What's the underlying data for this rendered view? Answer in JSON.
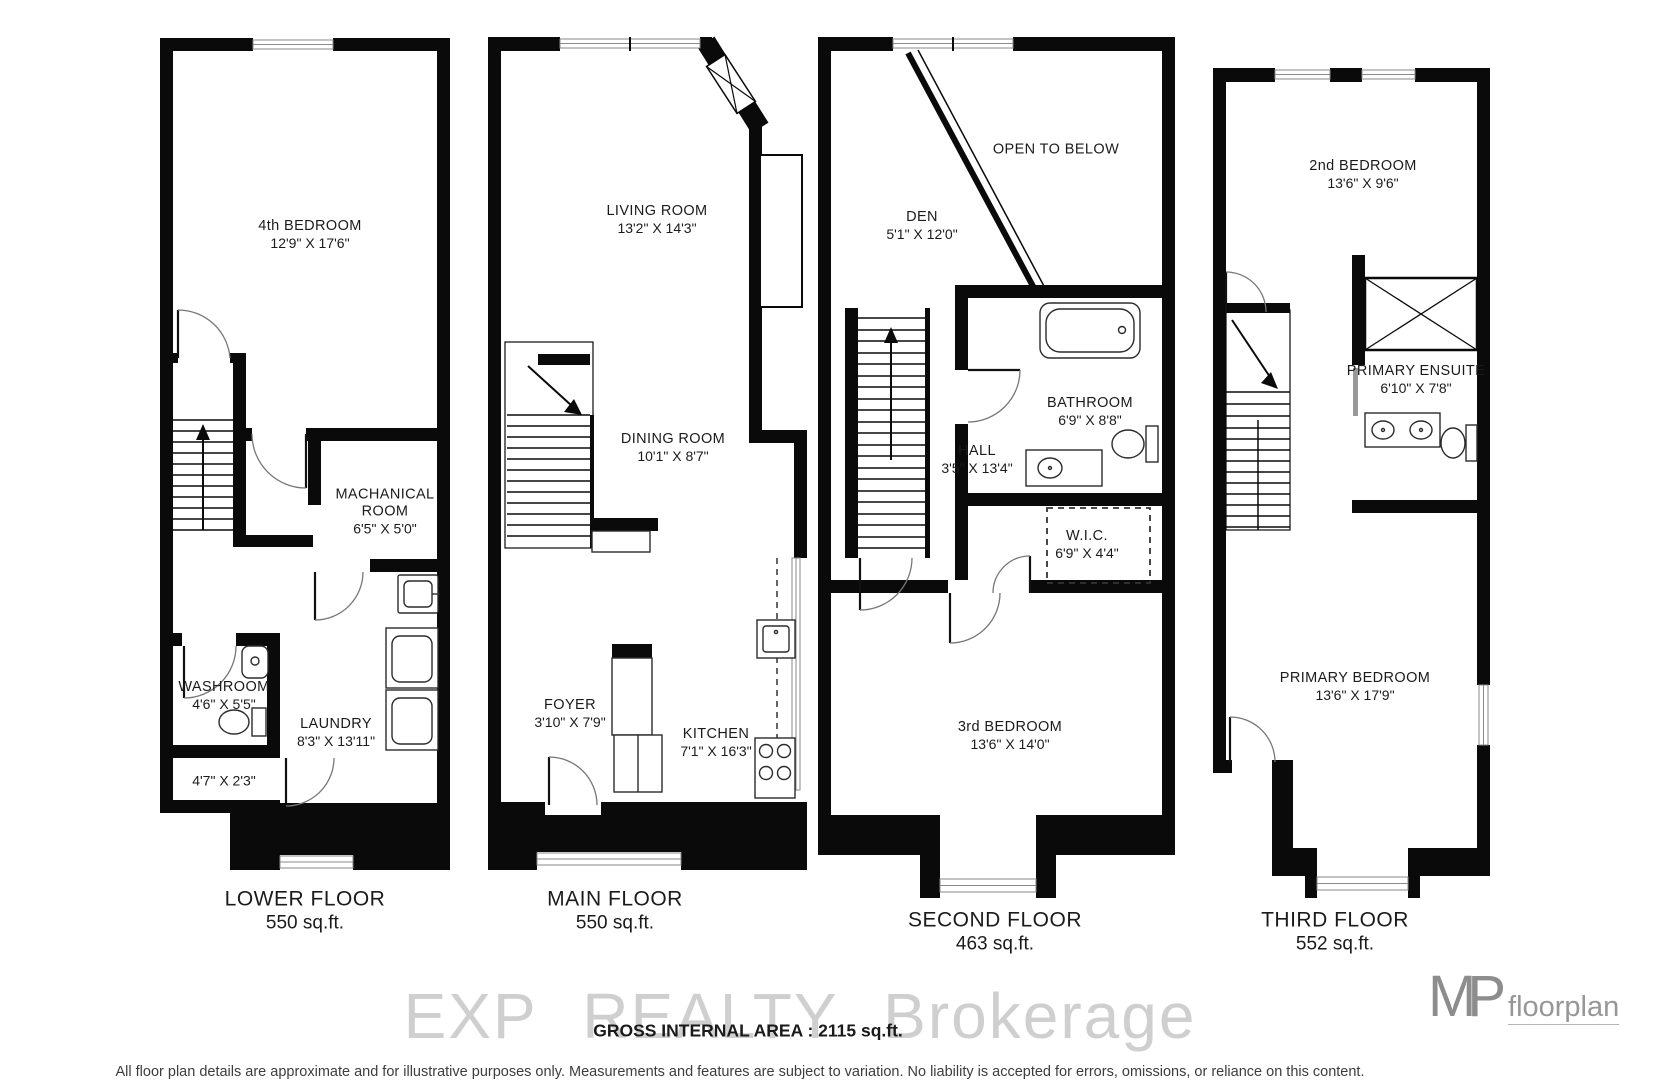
{
  "floors": [
    {
      "name": "LOWER FLOOR",
      "area": "550 sq.ft.",
      "rooms": [
        {
          "label": "4th BEDROOM",
          "dims": "12'9\" X 17'6\""
        },
        {
          "label": "MACHANICAL ROOM",
          "dims": "6'5\" X 5'0\""
        },
        {
          "label": "WASHROOM",
          "dims": "4'6\" X 5'5\""
        },
        {
          "label": "LAUNDRY",
          "dims": "8'3\" X 13'11\""
        },
        {
          "label": "",
          "dims": "4'7\" X 2'3\""
        }
      ]
    },
    {
      "name": "MAIN FLOOR",
      "area": "550 sq.ft.",
      "rooms": [
        {
          "label": "LIVING ROOM",
          "dims": "13'2\" X 14'3\""
        },
        {
          "label": "DINING ROOM",
          "dims": "10'1\" X 8'7\""
        },
        {
          "label": "FOYER",
          "dims": "3'10\" X 7'9\""
        },
        {
          "label": "KITCHEN",
          "dims": "7'1\" X 16'3\""
        }
      ]
    },
    {
      "name": "SECOND FLOOR",
      "area": "463 sq.ft.",
      "rooms": [
        {
          "label": "OPEN TO BELOW",
          "dims": ""
        },
        {
          "label": "DEN",
          "dims": "5'1\" X 12'0\""
        },
        {
          "label": "BATHROOM",
          "dims": "6'9\" X 8'8\""
        },
        {
          "label": "HALL",
          "dims": "3'5\" X 13'4\""
        },
        {
          "label": "W.I.C.",
          "dims": "6'9\" X 4'4\""
        },
        {
          "label": "3rd BEDROOM",
          "dims": "13'6\" X 14'0\""
        }
      ]
    },
    {
      "name": "THIRD FLOOR",
      "area": "552 sq.ft.",
      "rooms": [
        {
          "label": "2nd BEDROOM",
          "dims": "13'6\" X 9'6\""
        },
        {
          "label": "PRIMARY ENSUITE",
          "dims": "6'10\" X 7'8\""
        },
        {
          "label": "PRIMARY BEDROOM",
          "dims": "13'6\" X 17'9\""
        }
      ]
    }
  ],
  "footer": {
    "watermark": "EXP REALTY Brokerage",
    "gross_area": "GROSS INTERNAL AREA : 2115 sq.ft.",
    "disclaimer": "All floor plan details are approximate and for illustrative purposes only. Measurements and features are subject to variation. No liability is accepted for errors, omissions, or reliance on this content.",
    "logo_m": "M",
    "logo_p": "P",
    "logo_text": "floorplan"
  }
}
